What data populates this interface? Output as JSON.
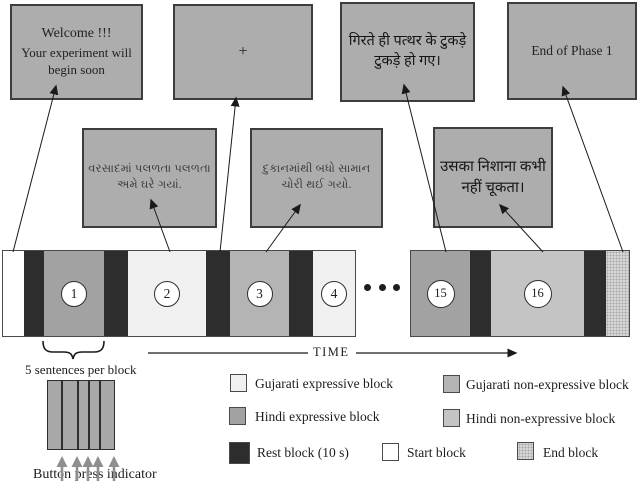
{
  "screens": {
    "welcome": {
      "line1": "Welcome !!!",
      "line2": "Your experiment will",
      "line3": "begin soon"
    },
    "fixation": {
      "symbol": "+"
    },
    "hindi_expressive": {
      "line1": "गिरते ही पत्थर के टुकड़े",
      "line2": "टुकड़े हो गए।"
    },
    "end_phase": {
      "label": "End of Phase 1"
    },
    "gujarati_expressive": {
      "line1": "વરસાદમાં પલળતા પલળતા",
      "line2": "અમે ઘરે ગયાં."
    },
    "gujarati_non_expressive": {
      "line1": "દુકાનમાંથી બધો સામાન",
      "line2": "ચોરી થઈ ગયો."
    },
    "hindi_non_expressive": {
      "line1": "उसका निशाना कभी",
      "line2": "नहीं चूकता।"
    }
  },
  "timeline": {
    "numbers": [
      "1",
      "2",
      "3",
      "4",
      "15",
      "16"
    ],
    "time_label": "TIME"
  },
  "annotations": {
    "sentences_label": "5 sentences per block",
    "button_label": "Button press indicator"
  },
  "legend": {
    "items": [
      {
        "label": "Gujarati expressive block",
        "color": "#f0f0f0"
      },
      {
        "label": "Gujarati non-expressive block",
        "color": "#b4b4b4"
      },
      {
        "label": "Hindi expressive block",
        "color": "#a2a2a2"
      },
      {
        "label": "Hindi non-expressive block",
        "color": "#c4c4c4"
      },
      {
        "label": "Rest block (10 s)",
        "color": "#2d2d2d"
      },
      {
        "label": "Start block",
        "color": "#ffffff"
      },
      {
        "label": "End block",
        "color": "#d6d6d6",
        "pattern": "dotted"
      }
    ]
  },
  "colors": {
    "screen_fill": "#adadad",
    "border": "#3d3d3d",
    "arrow": "#1a1a1a",
    "button_arrow": "#8f8f8f"
  }
}
